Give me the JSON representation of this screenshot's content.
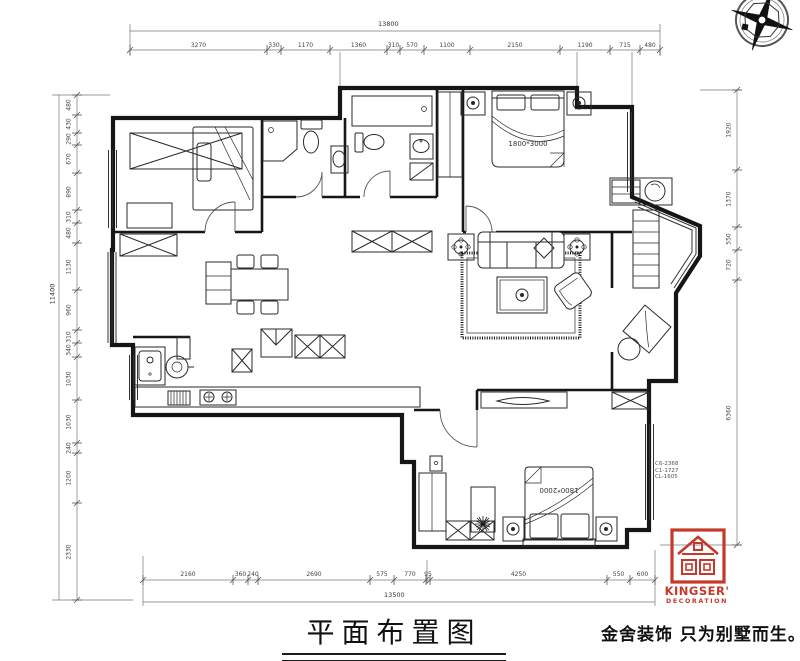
{
  "title": {
    "text": "平面布置图"
  },
  "branding": {
    "logo_line1": "KINGSER'",
    "logo_line2": "DECORATION",
    "slogan": "金舍装饰 只为别墅而生。",
    "logo_color": "#c5392b"
  },
  "labels": {
    "master_bed": "1800*3000",
    "second_bed": "1800*2000",
    "window_note": [
      "C6-2368",
      "C1-1727",
      "CL-1605"
    ]
  },
  "icons": {
    "compass": "compass-rose"
  },
  "dimensions": {
    "top": {
      "overall": "13800",
      "segments": [
        {
          "t": "3270",
          "w": 137
        },
        {
          "t": "330",
          "w": 14
        },
        {
          "t": "1170",
          "w": 49
        },
        {
          "t": "1360",
          "w": 57
        },
        {
          "t": "310",
          "w": 13
        },
        {
          "t": "570",
          "w": 24
        },
        {
          "t": "1100",
          "w": 46
        },
        {
          "t": "2150",
          "w": 90
        },
        {
          "t": "1190",
          "w": 50
        },
        {
          "t": "715",
          "w": 30
        },
        {
          "t": "480",
          "w": 20
        }
      ]
    },
    "bottom": {
      "overall": "13500",
      "segments": [
        {
          "t": "2160",
          "w": 90
        },
        {
          "t": "360",
          "w": 15
        },
        {
          "t": "240",
          "w": 10
        },
        {
          "t": "2690",
          "w": 112
        },
        {
          "t": "575",
          "w": 24
        },
        {
          "t": "770",
          "w": 32
        },
        {
          "t": "95",
          "w": 4
        },
        {
          "t": "4250",
          "w": 177
        },
        {
          "t": "550",
          "w": 23
        },
        {
          "t": "600",
          "w": 25
        }
      ]
    },
    "left": {
      "overall": "11400",
      "segments": [
        {
          "t": "480",
          "w": 20
        },
        {
          "t": "430",
          "w": 18
        },
        {
          "t": "290",
          "w": 12
        },
        {
          "t": "670",
          "w": 28
        },
        {
          "t": "890",
          "w": 37
        },
        {
          "t": "310",
          "w": 13
        },
        {
          "t": "480",
          "w": 20
        },
        {
          "t": "1130",
          "w": 47
        },
        {
          "t": "960",
          "w": 40
        },
        {
          "t": "310",
          "w": 13
        },
        {
          "t": "340",
          "w": 14
        },
        {
          "t": "1030",
          "w": 43
        },
        {
          "t": "1030",
          "w": 43
        },
        {
          "t": "240",
          "w": 10
        },
        {
          "t": "1200",
          "w": 50
        },
        {
          "t": "2330",
          "w": 97
        }
      ]
    },
    "right": {
      "segments": [
        {
          "t": "1920",
          "w": 80
        },
        {
          "t": "1370",
          "w": 57
        },
        {
          "t": "550",
          "w": 23
        },
        {
          "t": "720",
          "w": 30
        },
        {
          "t": "6360",
          "w": 265
        }
      ]
    }
  }
}
